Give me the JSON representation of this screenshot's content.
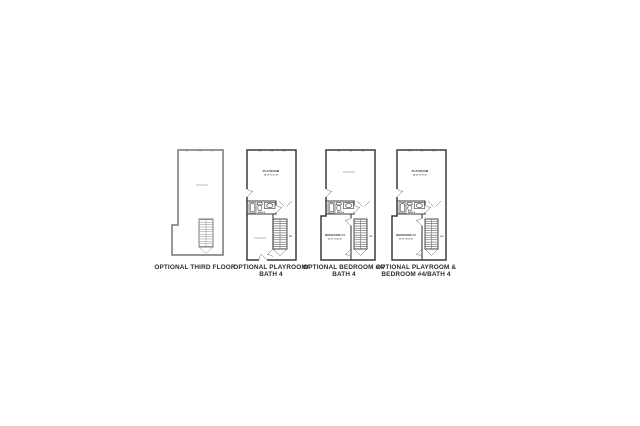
{
  "sheet": {
    "background": "#ffffff"
  },
  "colors": {
    "wall_dark": "#3b3b3b",
    "wall_light": "#757575",
    "label_muted": "#b5b5b5",
    "caption_text": "#2b2b2b"
  },
  "plans": [
    {
      "caption_line1": "OPTIONAL THIRD FLOOR",
      "caption_line2": "",
      "storage_label": "STORAGE"
    },
    {
      "caption_line1": "OPTIONAL PLAYROOM/",
      "caption_line2": "BATH 4",
      "playroom_label": "PLAYROOM",
      "playroom_dims": "16'-4\" X 17'-0\"",
      "bath_label": "BATH 4",
      "storage_label": "STORAGE",
      "stairs_label": "DN"
    },
    {
      "caption_line1": "OPTIONAL BEDROOM #4/",
      "caption_line2": "BATH 4",
      "storage_label": "STORAGE",
      "bath_label": "BATH 4",
      "bedroom_label": "BEDROOM #4",
      "bedroom_dims": "11'-0\" X 12'-0\"",
      "stairs_label": "DN"
    },
    {
      "caption_line1": "OPTIONAL PLAYROOM &",
      "caption_line2": "BEDROOM #4/BATH 4",
      "playroom_label": "PLAYROOM",
      "playroom_dims": "16'-4\" X 17'-0\"",
      "bath_label": "BATH 4",
      "bedroom_label": "BEDROOM #4",
      "bedroom_dims": "11'-0\" X 12'-0\"",
      "stairs_label": "DN"
    }
  ]
}
